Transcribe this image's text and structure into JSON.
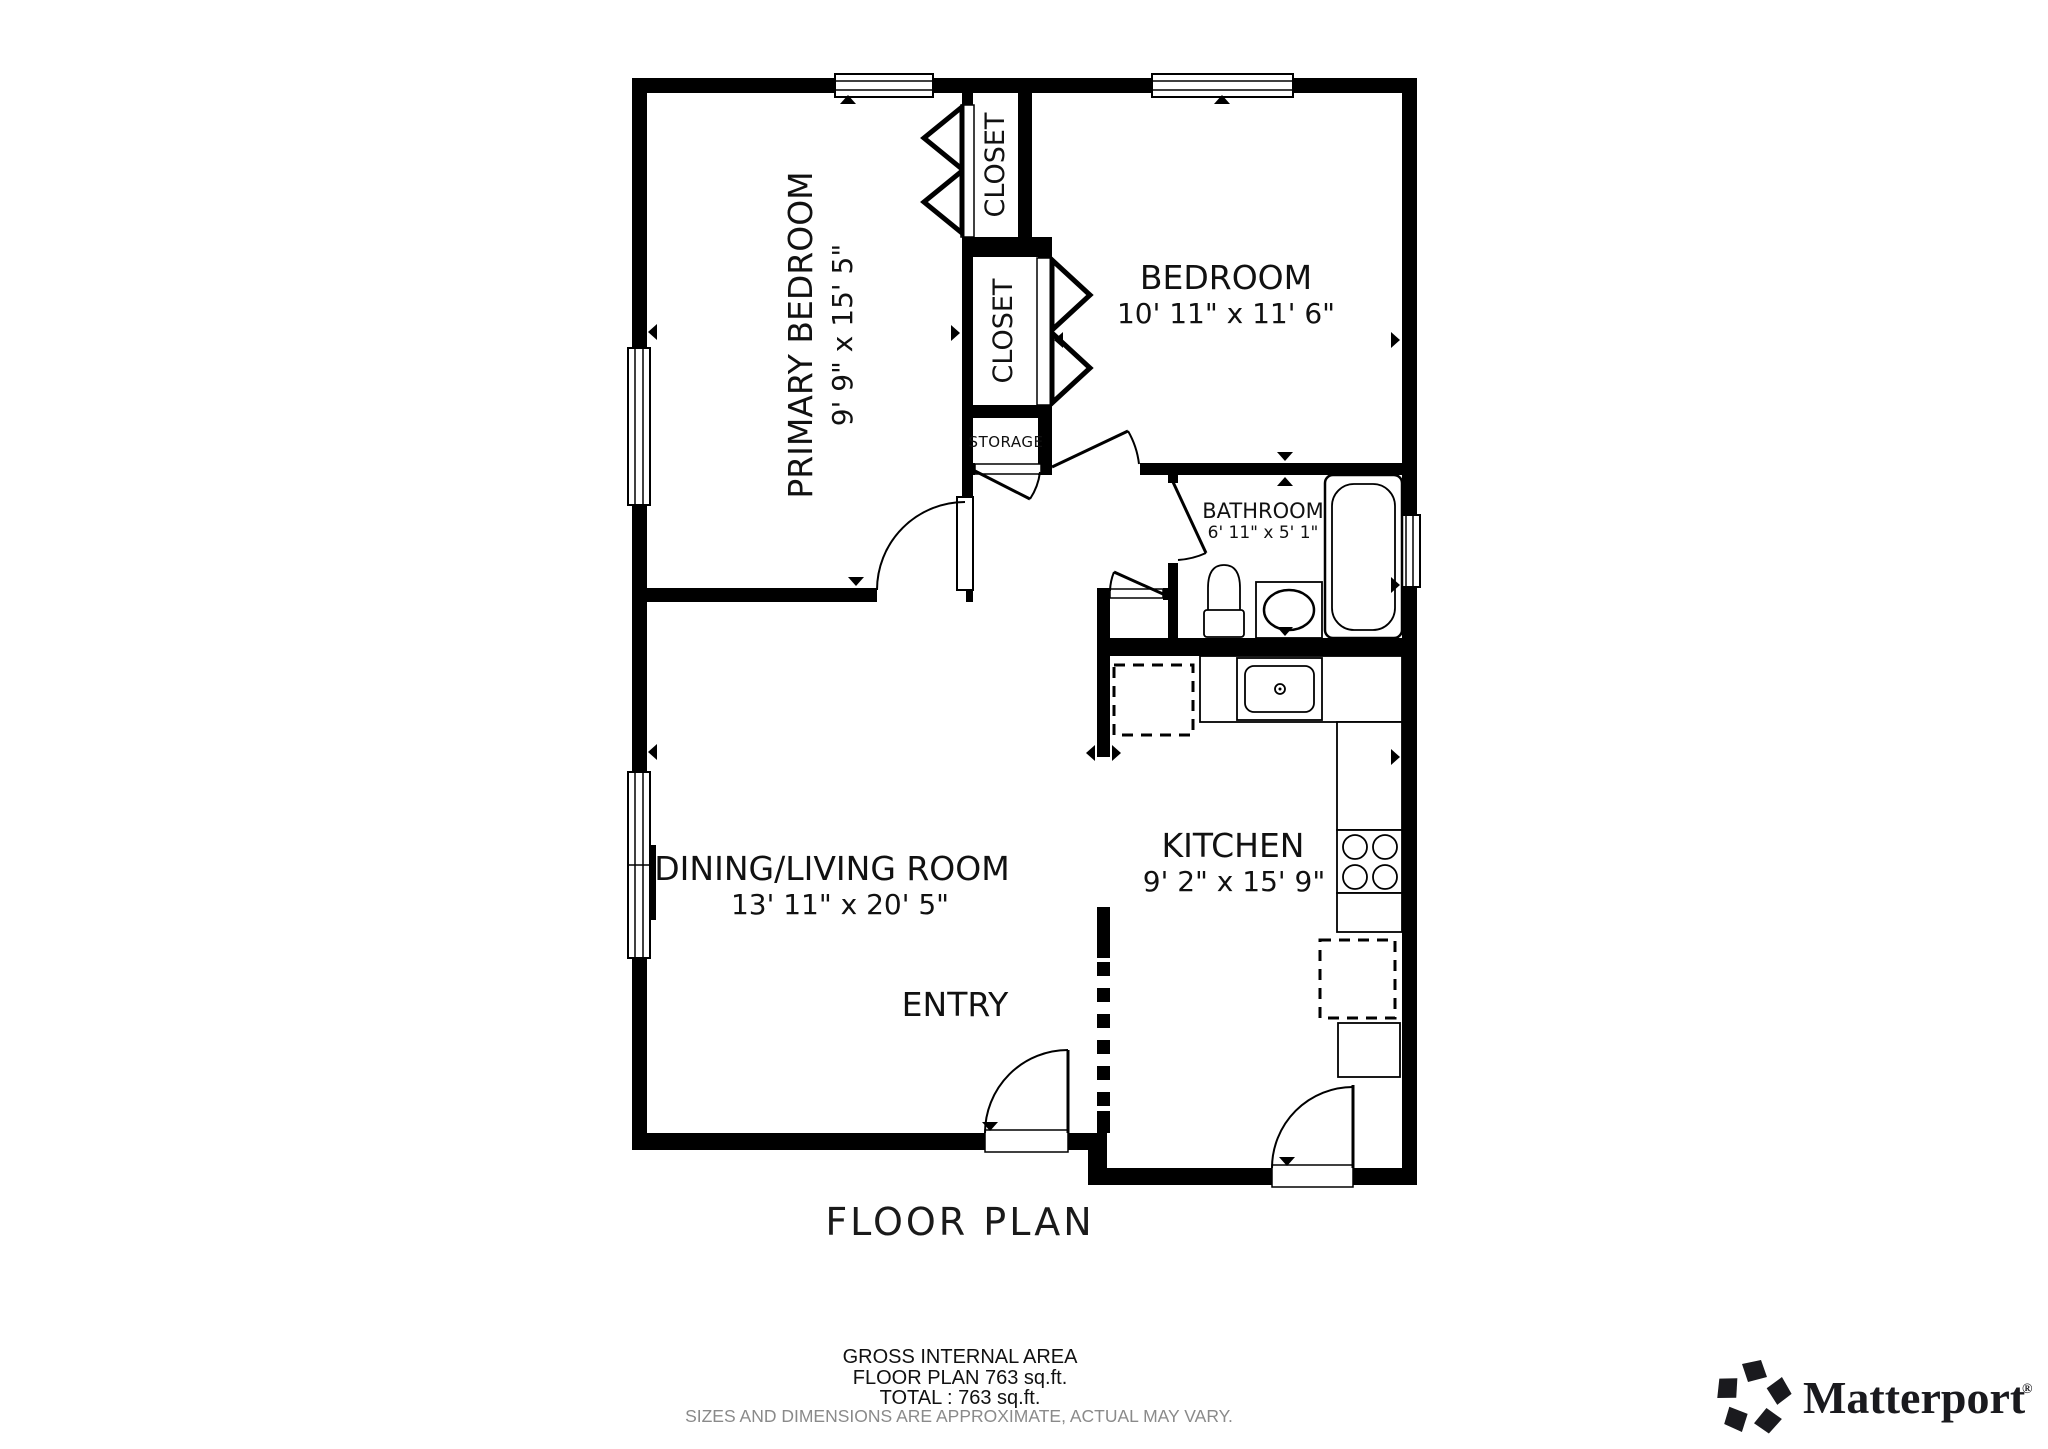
{
  "title": "FLOOR PLAN",
  "rooms": {
    "primary_bedroom": {
      "name": "PRIMARY BEDROOM",
      "dims": "9' 9\" x 15' 5\""
    },
    "bedroom": {
      "name": "BEDROOM",
      "dims": "10' 11\" x 11' 6\""
    },
    "bathroom": {
      "name": "BATHROOM",
      "dims": "6' 11\" x 5' 1\""
    },
    "dining_living_room": {
      "name": "DINING/LIVING ROOM",
      "dims": "13' 11\" x 20' 5\""
    },
    "kitchen": {
      "name": "KITCHEN",
      "dims": "9' 2\" x 15' 9\""
    },
    "closet_top": {
      "name": "CLOSET"
    },
    "closet_bottom": {
      "name": "CLOSET"
    },
    "storage": {
      "name": "STORAGE"
    },
    "entry": {
      "name": "ENTRY"
    }
  },
  "footer": {
    "gross_internal_area": "GROSS INTERNAL AREA",
    "floor_plan_area": "FLOOR PLAN 763 sq.ft.",
    "total": "TOTAL :  763 sq.ft.",
    "disclaimer": "SIZES AND DIMENSIONS ARE APPROXIMATE, ACTUAL MAY VARY."
  },
  "branding": {
    "logo_icon": "matterport-pinwheel-icon",
    "logo_text": "Matterport",
    "registered_mark": "®"
  },
  "colors": {
    "walls": "#000000",
    "background": "#ffffff",
    "label_text": "#111111",
    "disclaimer_text": "#8a8a8a"
  }
}
